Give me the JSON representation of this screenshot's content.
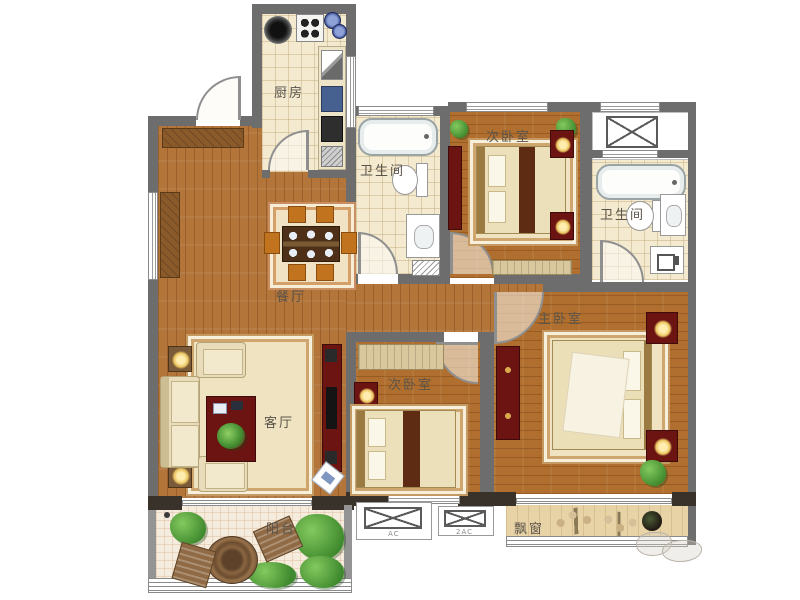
{
  "rooms": {
    "kitchen": {
      "label": "厨房"
    },
    "bath_top": {
      "label": "卫生间"
    },
    "bedroom_top": {
      "label": "次卧室"
    },
    "bath_right": {
      "label": "卫生间"
    },
    "master_bedroom": {
      "label": "主卧室"
    },
    "dining": {
      "label": "餐厅"
    },
    "living": {
      "label": "客厅"
    },
    "bedroom_mid": {
      "label": "次卧室"
    },
    "balcony": {
      "label": "阳台"
    },
    "bay_window": {
      "label": "飘窗"
    }
  },
  "annotations": {
    "ac_left": "AC",
    "ac_right": "2AC"
  },
  "colors": {
    "wall": "#6d6d6d",
    "wall_dark": "#39322a",
    "wood_floor": "#b3753a",
    "tile_floor": "#f3ead0",
    "balcony_tile": "#f6ecdd",
    "bay_wood": "#e8d3a7",
    "furniture_accent": "#6b1412",
    "chair_orange": "#c1731d",
    "plant_green": "#4e9a3d",
    "label_text": "#5b544a"
  }
}
